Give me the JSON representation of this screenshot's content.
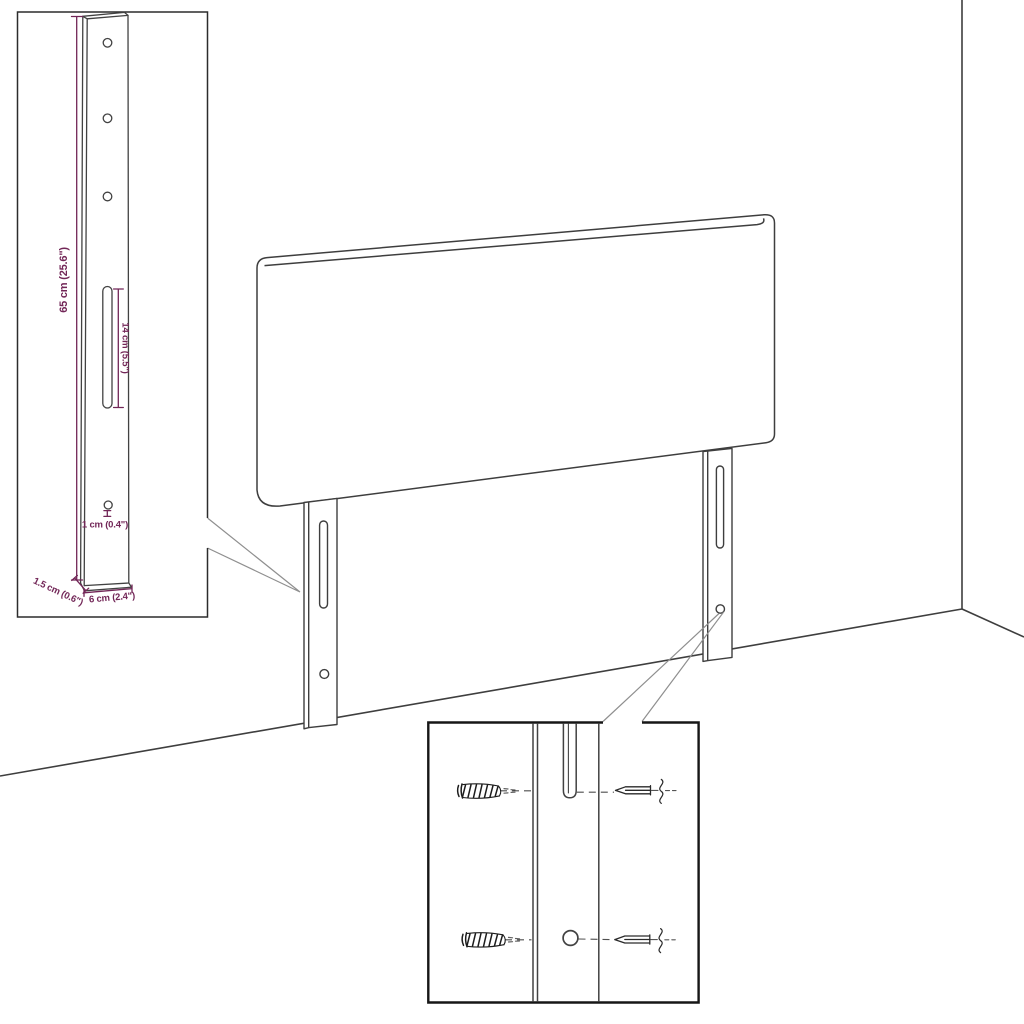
{
  "inset_top": {
    "labels": {
      "leg_height": "65 cm (25.6\")",
      "slot_length": "14 cm (5.5\")",
      "hole_diameter": "1 cm (0.4\")",
      "leg_thickness": "1.5 cm (0.6\")",
      "leg_width": "6 cm (2.4\")"
    }
  },
  "colors": {
    "dimension_accent": "#722657",
    "drawing_line": "#3e3e3e",
    "callout_line": "#8f8f8f",
    "inset_border_top": "#2c2c2c",
    "inset_border_bottom": "#161616",
    "background": "#ffffff"
  }
}
